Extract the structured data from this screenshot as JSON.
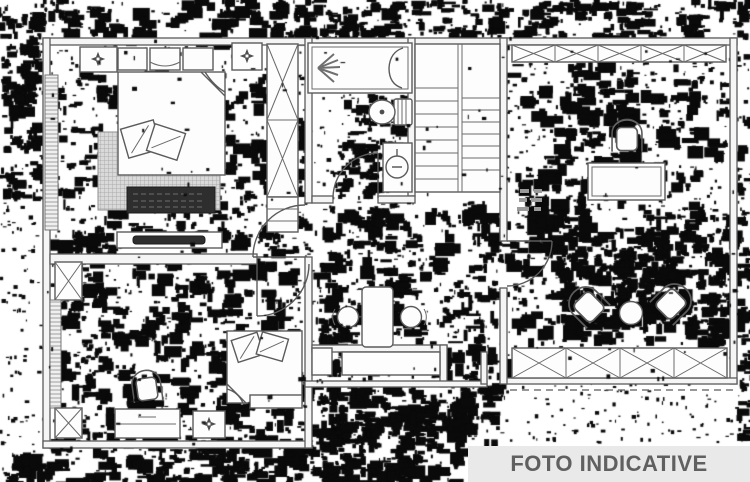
{
  "watermark": {
    "label": "FOTO INDICATIVE"
  },
  "colors": {
    "banner_bg": "#e9e9e9",
    "banner_text": "#606060",
    "plan_line": "#5b5b5b",
    "noise_ink": "#0a0a0a",
    "paper": "#ffffff",
    "rug_fill": "#d9d9d9",
    "ottoman_fill": "#2e2e2e"
  },
  "plan_symbols": [
    "double-bed",
    "pillows",
    "rug",
    "ottoman",
    "tv-console",
    "nightstand-compass",
    "wardrobe-x-box",
    "radiator-hatch",
    "shower-tub",
    "toilet",
    "washbasin",
    "stairs",
    "door-swing",
    "desk",
    "office-chair",
    "tub-chair",
    "armchair",
    "coffee-table",
    "round-basin",
    "vanity-counter",
    "dresser",
    "window-x-band",
    "balcony-dashed-line"
  ]
}
